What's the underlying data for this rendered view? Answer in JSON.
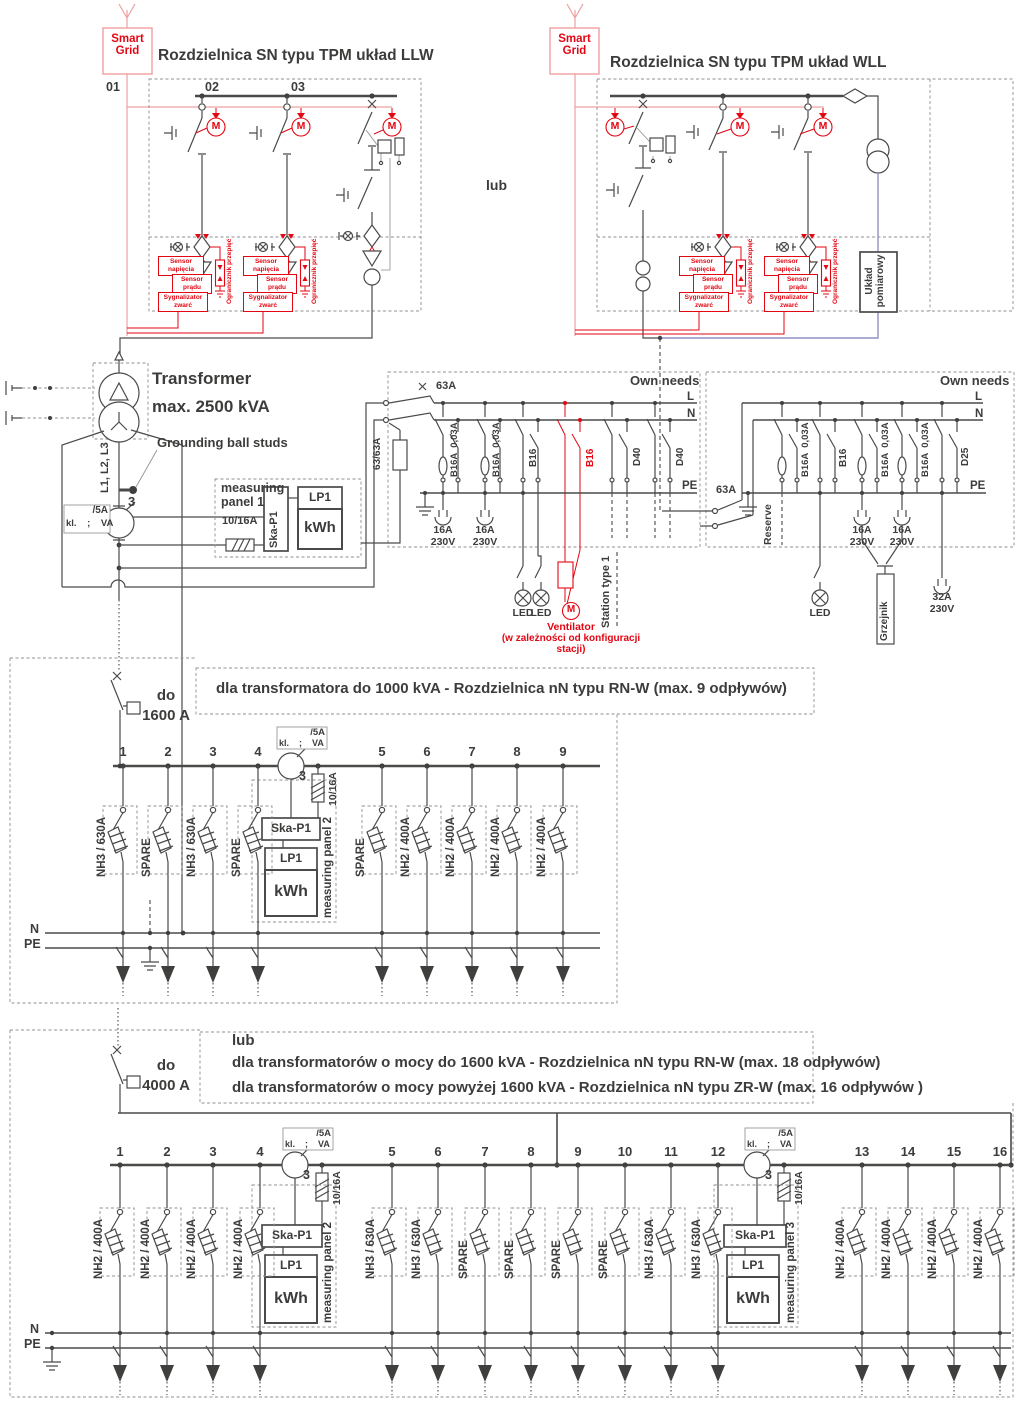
{
  "colors": {
    "accent_red": "#e30613",
    "line_dark": "#4a4a49",
    "smartgrid_pink": "#efa0a0",
    "measuring_purple": "#9191c6"
  },
  "top": {
    "smart_grid": "Smart Grid",
    "llw_title": "Rozdzielnica SN typu TPM układ LLW",
    "wll_title": "Rozdzielnica SN typu TPM układ WLL",
    "lub": "lub",
    "bays": [
      "01",
      "02",
      "03"
    ],
    "motor": "M",
    "uklad_pomiarowy": "Układ pomiarowy",
    "sensor_voltage": "Sensor napięcia",
    "sensor_current": "Sensor prądu",
    "sensor_short": "Sygnalizator zwarć",
    "surge_arrester": "Ogranicznik przepięć"
  },
  "transformer": {
    "name": "Transformer",
    "rating": "max. 2500 kVA",
    "grounding": "Grounding ball studs",
    "phases": "L1, L2, L3",
    "ct_count": "3"
  },
  "ct_box": {
    "top": "/5A",
    "bottom": "kl.    ;    VA"
  },
  "panel1": {
    "title": "measuring panel 1",
    "fuse": "10/16A",
    "ska": "Ska-P1",
    "lp": "LP1",
    "kwh": "kWh"
  },
  "own_left": {
    "title": "Own needs",
    "main_switch": "63A",
    "riser_fuse": "63/63A",
    "l": "L",
    "n": "N",
    "pe": "PE",
    "b_rcd": "B16A  0,03A",
    "b16": "B16",
    "d40": "D40",
    "socket_a": "16A",
    "socket_v": "230V",
    "led": "LED",
    "vent": "Ventilator",
    "vent_note": "(w zależności od konfiguracji stacji)",
    "station": "Station type 1"
  },
  "own_right": {
    "title": "Own needs",
    "main_switch": "63A",
    "reserve": "Reserve",
    "l": "L",
    "n": "N",
    "pe": "PE",
    "b_rcd": "B16A  0,03A",
    "b16": "B16",
    "d25": "D25",
    "socket_a": "16A",
    "socket_v": "230V",
    "led": "LED",
    "heater": "Grzejnik",
    "socket32_a": "32A",
    "socket32_v": "230V"
  },
  "nn1": {
    "rating_prefix": "do",
    "rating": "1600 A",
    "title": "dla transformatora do 1000 kVA - Rozdzielnica nN typu RN-W (max. 9 odpływów)",
    "ct_count": "3",
    "fuse": "10/16A",
    "n": "N",
    "pe": "PE",
    "panel": {
      "ska": "Ska-P1",
      "lp": "LP1",
      "kwh": "kWh",
      "title": "measuring panel 2"
    },
    "feeders": [
      {
        "no": "1",
        "label": "NH3 / 630A"
      },
      {
        "no": "2",
        "label": "SPARE"
      },
      {
        "no": "3",
        "label": "NH3 / 630A"
      },
      {
        "no": "4",
        "label": "SPARE"
      },
      {
        "no": "5",
        "label": "SPARE"
      },
      {
        "no": "6",
        "label": "NH2 / 400A"
      },
      {
        "no": "7",
        "label": "NH2 / 400A"
      },
      {
        "no": "8",
        "label": "NH2 / 400A"
      },
      {
        "no": "9",
        "label": "NH2 / 400A"
      }
    ]
  },
  "nn2": {
    "lub": "lub",
    "rating_prefix": "do",
    "rating": "4000 A",
    "title1": "dla transformatorów o mocy do 1600 kVA - Rozdzielnica nN typu RN-W (max. 18 odpływów)",
    "title2": "dla transformatorów o mocy powyżej 1600 kVA - Rozdzielnica nN typu ZR-W (max. 16 odpływów )",
    "ct_count": "3",
    "fuse": "10/16A",
    "n": "N",
    "pe": "PE",
    "panel2": {
      "ska": "Ska-P1",
      "lp": "LP1",
      "kwh": "kWh",
      "title": "measuring panel 2"
    },
    "panel3": {
      "ska": "Ska-P1",
      "lp": "LP1",
      "kwh": "kWh",
      "title": "measuring panel 3"
    },
    "feeders": [
      {
        "no": "1",
        "label": "NH2 / 400A"
      },
      {
        "no": "2",
        "label": "NH2 / 400A"
      },
      {
        "no": "3",
        "label": "NH2 / 400A"
      },
      {
        "no": "4",
        "label": "NH2 / 400A"
      },
      {
        "no": "5",
        "label": "NH3 / 630A"
      },
      {
        "no": "6",
        "label": "NH3 / 630A"
      },
      {
        "no": "7",
        "label": "SPARE"
      },
      {
        "no": "8",
        "label": "SPARE"
      },
      {
        "no": "9",
        "label": "SPARE"
      },
      {
        "no": "10",
        "label": "SPARE"
      },
      {
        "no": "11",
        "label": "NH3 / 630A"
      },
      {
        "no": "12",
        "label": "NH3 / 630A"
      },
      {
        "no": "13",
        "label": "NH2 / 400A"
      },
      {
        "no": "14",
        "label": "NH2 / 400A"
      },
      {
        "no": "15",
        "label": "NH2 / 400A"
      },
      {
        "no": "16",
        "label": "NH2 / 400A"
      }
    ]
  }
}
